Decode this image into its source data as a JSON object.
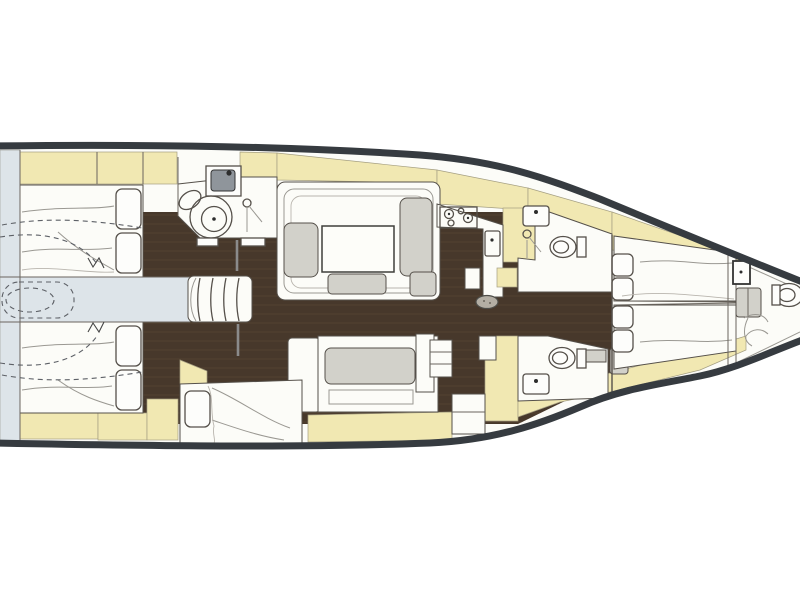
{
  "figure": {
    "kind": "sailing-yacht-interior-floor-plan",
    "view": "top-down",
    "bow_direction": "right",
    "stern_direction": "left",
    "visible_text": "none",
    "aria_label": "Scanned top-down interior layout plan of a sailing yacht, bow to the right"
  },
  "palette": {
    "page-bg": "#ffffff",
    "hull-line": "#363b40",
    "interior": "#fcfcf8",
    "floor-dark": "#47382b",
    "floor-plank": "#5d4a36",
    "accent-yellow": "#f1e8b2",
    "cockpit-blue": "#dde4e9",
    "cushion-gray": "#d2d1ca",
    "outline": "#55504a",
    "soft-line": "#9a9892"
  },
  "areas": {
    "rooms": [
      "aft-cockpit-passage",
      "aft-cabin-port",
      "aft-cabin-starboard",
      "aft-head-shower",
      "companionway-stairs",
      "saloon-dinette",
      "saloon-settee",
      "single-berth-cabin",
      "galley",
      "mid-head-port",
      "mid-head-starboard",
      "forward-cabin-vberths",
      "bow-forepeak"
    ],
    "fixtures": [
      "double-bed",
      "pillows",
      "shower-tray",
      "washbasin",
      "toilet",
      "four-burner-stove",
      "dinette-table",
      "ottoman",
      "mast",
      "stairs",
      "lockers",
      "wardrobe"
    ]
  }
}
